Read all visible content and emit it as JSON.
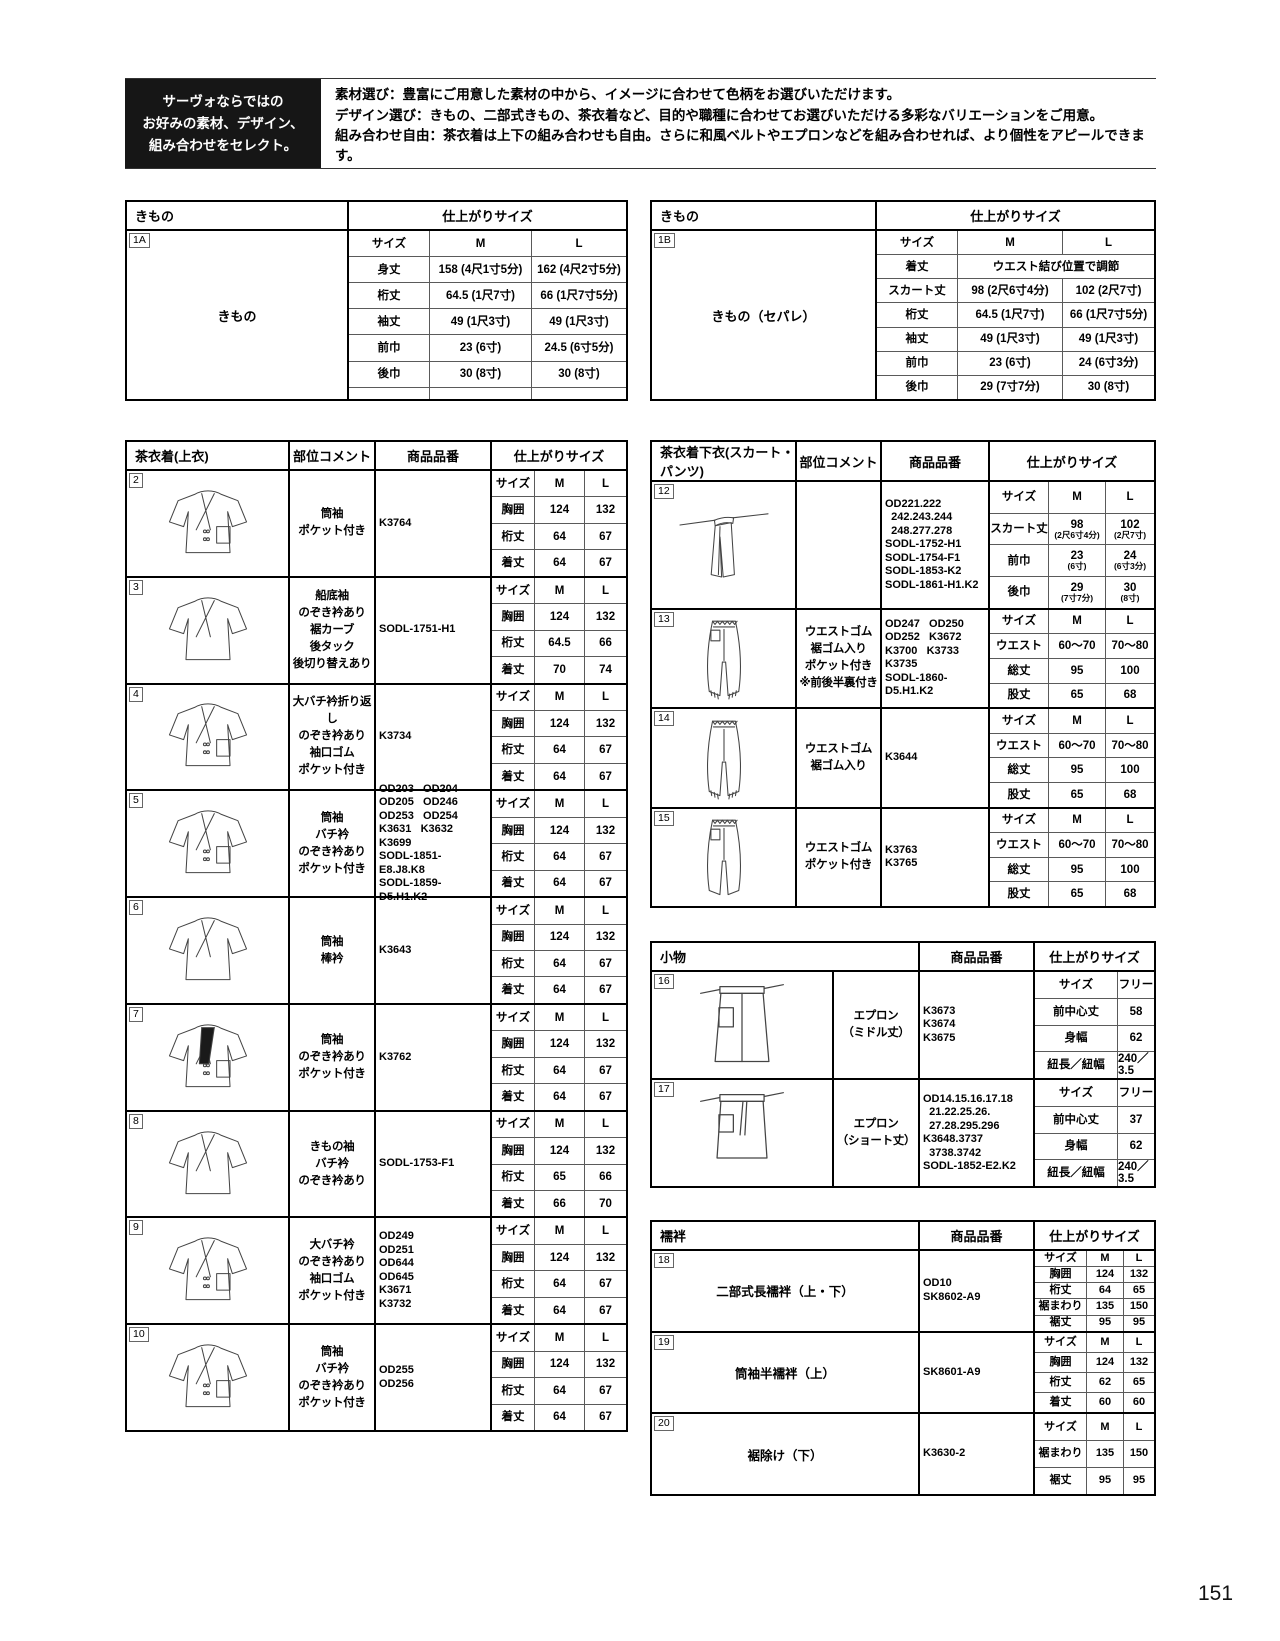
{
  "colors": {
    "header_box_bg": "#161616",
    "border_black": "#000000",
    "grid_gray": "#5a5a5a"
  },
  "header": {
    "select_box": "サーヴォならではの\nお好みの素材、デザイン、\n組み合わせをセレクト。",
    "lines": [
      "素材選び：豊富にご用意した素材の中から、イメージに合わせて色柄をお選びいただけます。",
      "デザイン選び：きもの、二部式きもの、茶衣着など、目的や職種に合わせてお選びいただける多彩なバリエーションをご用意。",
      "組み合わせ自由：茶衣着は上下の組み合わせも自由。さらに和風ベルトやエプロンなどを組み合わせれば、より個性をアピールできます。"
    ]
  },
  "page_number": "151",
  "tables": {
    "kimono_a": {
      "title": "きもの",
      "size_title": "仕上がりサイズ",
      "id": "1A",
      "product_name": "きもの",
      "size": [
        [
          "サイズ",
          "M",
          "L"
        ],
        [
          "身丈",
          "158 (4尺1寸5分)",
          "162 (4尺2寸5分)"
        ],
        [
          "桁丈",
          "64.5 (1尺7寸)",
          "66 (1尺7寸5分)"
        ],
        [
          "袖丈",
          "49 (1尺3寸)",
          "49 (1尺3寸)"
        ],
        [
          "前巾",
          "23 (6寸)",
          "24.5 (6寸5分)"
        ],
        [
          "後巾",
          "30 (8寸)",
          "30 (8寸)"
        ],
        [
          "",
          "",
          ""
        ]
      ]
    },
    "kimono_b": {
      "title": "きもの",
      "size_title": "仕上がりサイズ",
      "id": "1B",
      "product_name": "きもの（セパレ）",
      "size": [
        [
          "サイズ",
          "M",
          "L"
        ],
        [
          "着丈",
          "ウエスト結び位置で調節"
        ],
        [
          "スカート丈",
          "98 (2尺6寸4分)",
          "102 (2尺7寸)"
        ],
        [
          "桁丈",
          "64.5 (1尺7寸)",
          "66 (1尺7寸5分)"
        ],
        [
          "袖丈",
          "49 (1尺3寸)",
          "49 (1尺3寸)"
        ],
        [
          "前巾",
          "23 (6寸)",
          "24 (6寸3分)"
        ],
        [
          "後巾",
          "29 (7寸7分)",
          "30 (8寸)"
        ]
      ]
    },
    "uwagi": {
      "header": [
        "茶衣着(上衣)",
        "部位コメント",
        "商品品番",
        "仕上がりサイズ"
      ],
      "rows": [
        {
          "badge": "2",
          "art": "jacket-pocket",
          "comment": "筒袖\nポケット付き",
          "code": "K3764",
          "size": [
            [
              "サイズ",
              "M",
              "L"
            ],
            [
              "胸囲",
              "124",
              "132"
            ],
            [
              "桁丈",
              "64",
              "67"
            ],
            [
              "着丈",
              "64",
              "67"
            ]
          ]
        },
        {
          "badge": "3",
          "art": "jacket",
          "comment": "船底袖\nのぞき衿あり\n裾カーブ\n後タック\n後切り替えあり",
          "code": "SODL-1751-H1",
          "size": [
            [
              "サイズ",
              "M",
              "L"
            ],
            [
              "胸囲",
              "124",
              "132"
            ],
            [
              "桁丈",
              "64.5",
              "66"
            ],
            [
              "着丈",
              "70",
              "74"
            ]
          ]
        },
        {
          "badge": "4",
          "art": "jacket-pocket",
          "comment": "大バチ衿折り返し\nのぞき衿あり\n袖口ゴム\nポケット付き",
          "code": "K3734",
          "size": [
            [
              "サイズ",
              "M",
              "L"
            ],
            [
              "胸囲",
              "124",
              "132"
            ],
            [
              "桁丈",
              "64",
              "67"
            ],
            [
              "着丈",
              "64",
              "67"
            ]
          ]
        },
        {
          "badge": "5",
          "art": "jacket-pocket",
          "comment": "筒袖\nバチ衿\nのぞき衿あり\nポケット付き",
          "code": "OD203   OD204\nOD205   OD246\nOD253   OD254\nK3631   K3632\nK3699\nSODL-1851-E8.J8.K8\nSODL-1859-D5.H1.K2",
          "size": [
            [
              "サイズ",
              "M",
              "L"
            ],
            [
              "胸囲",
              "124",
              "132"
            ],
            [
              "桁丈",
              "64",
              "67"
            ],
            [
              "着丈",
              "64",
              "67"
            ]
          ]
        },
        {
          "badge": "6",
          "art": "jacket",
          "comment": "筒袖\n棒衿",
          "code": "K3643",
          "size": [
            [
              "サイズ",
              "M",
              "L"
            ],
            [
              "胸囲",
              "124",
              "132"
            ],
            [
              "桁丈",
              "64",
              "67"
            ],
            [
              "着丈",
              "64",
              "67"
            ]
          ]
        },
        {
          "badge": "7",
          "art": "jacket-dark",
          "comment": "筒袖\nのぞき衿あり\nポケット付き",
          "code": "K3762",
          "size": [
            [
              "サイズ",
              "M",
              "L"
            ],
            [
              "胸囲",
              "124",
              "132"
            ],
            [
              "桁丈",
              "64",
              "67"
            ],
            [
              "着丈",
              "64",
              "67"
            ]
          ]
        },
        {
          "badge": "8",
          "art": "jacket",
          "comment": "きもの袖\nバチ衿\nのぞき衿あり",
          "code": "SODL-1753-F1",
          "size": [
            [
              "サイズ",
              "M",
              "L"
            ],
            [
              "胸囲",
              "124",
              "132"
            ],
            [
              "桁丈",
              "65",
              "66"
            ],
            [
              "着丈",
              "66",
              "70"
            ]
          ]
        },
        {
          "badge": "9",
          "art": "jacket-pocket",
          "comment": "大バチ衿\nのぞき衿あり\n袖口ゴム\nポケット付き",
          "code": "OD249\nOD251\nOD644\nOD645\nK3671\nK3732",
          "size": [
            [
              "サイズ",
              "M",
              "L"
            ],
            [
              "胸囲",
              "124",
              "132"
            ],
            [
              "桁丈",
              "64",
              "67"
            ],
            [
              "着丈",
              "64",
              "67"
            ]
          ]
        },
        {
          "badge": "10",
          "art": "jacket-pocket",
          "comment": "筒袖\nバチ衿\nのぞき衿あり\nポケット付き",
          "code": "OD255\nOD256",
          "size": [
            [
              "サイズ",
              "M",
              "L"
            ],
            [
              "胸囲",
              "124",
              "132"
            ],
            [
              "桁丈",
              "64",
              "67"
            ],
            [
              "着丈",
              "64",
              "67"
            ]
          ]
        }
      ]
    },
    "shitagi": {
      "header": [
        "茶衣着下衣(スカート・パンツ)",
        "部位コメント",
        "商品品番",
        "仕上がりサイズ"
      ],
      "rows": [
        {
          "badge": "12",
          "art": "skirt",
          "comment": "",
          "code": "OD221.222\n  242.243.244\n  248.277.278\nSODL-1752-H1\nSODL-1754-F1\nSODL-1853-K2\nSODL-1861-H1.K2",
          "size": [
            [
              "サイズ",
              "M",
              "L"
            ],
            [
              "スカート丈",
              "98\n(2尺6寸4分)",
              "102\n(2尺7寸)"
            ],
            [
              "前巾",
              "23\n(6寸)",
              "24\n(6寸3分)"
            ],
            [
              "後巾",
              "29\n(7寸7分)",
              "30\n(8寸)"
            ]
          ]
        },
        {
          "badge": "13",
          "art": "pants-a",
          "comment": "ウエストゴム\n裾ゴム入り\nポケット付き\n※前後半裏付き",
          "code": "OD247   OD250\nOD252   K3672\nK3700   K3733\nK3735\nSODL-1860-D5.H1.K2",
          "size": [
            [
              "サイズ",
              "M",
              "L"
            ],
            [
              "ウエスト",
              "60〜70",
              "70〜80"
            ],
            [
              "総丈",
              "95",
              "100"
            ],
            [
              "股丈",
              "65",
              "68"
            ]
          ]
        },
        {
          "badge": "14",
          "art": "pants-b",
          "comment": "ウエストゴム\n裾ゴム入り",
          "code": "K3644",
          "size": [
            [
              "サイズ",
              "M",
              "L"
            ],
            [
              "ウエスト",
              "60〜70",
              "70〜80"
            ],
            [
              "総丈",
              "95",
              "100"
            ],
            [
              "股丈",
              "65",
              "68"
            ]
          ]
        },
        {
          "badge": "15",
          "art": "pants-c",
          "comment": "ウエストゴム\nポケット付き",
          "code": "K3763\nK3765",
          "size": [
            [
              "サイズ",
              "M",
              "L"
            ],
            [
              "ウエスト",
              "60〜70",
              "70〜80"
            ],
            [
              "総丈",
              "95",
              "100"
            ],
            [
              "股丈",
              "65",
              "68"
            ]
          ]
        }
      ]
    },
    "komono": {
      "header": [
        "小物",
        "商品品番",
        "仕上がりサイズ"
      ],
      "rows": [
        {
          "badge": "16",
          "art": "apron",
          "comment": "エプロン\n（ミドル丈）",
          "code": "K3673\nK3674\nK3675",
          "size": [
            [
              "サイズ",
              "フリー"
            ],
            [
              "前中心丈",
              "58"
            ],
            [
              "身幅",
              "62"
            ],
            [
              "紐長／紐幅",
              "240／3.5"
            ]
          ]
        },
        {
          "badge": "17",
          "art": "apron-short",
          "comment": "エプロン\n（ショート丈）",
          "code": "OD14.15.16.17.18\n  21.22.25.26.\n  27.28.295.296\nK3648.3737\n  3738.3742\nSODL-1852-E2.K2",
          "size": [
            [
              "サイズ",
              "フリー"
            ],
            [
              "前中心丈",
              "37"
            ],
            [
              "身幅",
              "62"
            ],
            [
              "紐長／紐幅",
              "240／3.5"
            ]
          ]
        }
      ]
    },
    "juban": {
      "header": [
        "襦袢",
        "商品品番",
        "仕上がりサイズ"
      ],
      "rows": [
        {
          "badge": "18",
          "name": "二部式長襦袢（上・下）",
          "code": "OD10\nSK8602-A9",
          "size": [
            [
              "サイズ",
              "M",
              "L"
            ],
            [
              "胸囲",
              "124",
              "132"
            ],
            [
              "桁丈",
              "64",
              "65"
            ],
            [
              "裾まわり",
              "135",
              "150"
            ],
            [
              "裾丈",
              "95",
              "95"
            ]
          ]
        },
        {
          "badge": "19",
          "name": "筒袖半襦袢（上）",
          "code": "SK8601-A9",
          "size": [
            [
              "サイズ",
              "M",
              "L"
            ],
            [
              "胸囲",
              "124",
              "132"
            ],
            [
              "桁丈",
              "62",
              "65"
            ],
            [
              "着丈",
              "60",
              "60"
            ]
          ]
        },
        {
          "badge": "20",
          "name": "裾除け（下）",
          "code": "K3630-2",
          "size": [
            [
              "サイズ",
              "M",
              "L"
            ],
            [
              "裾まわり",
              "135",
              "150"
            ],
            [
              "裾丈",
              "95",
              "95"
            ]
          ]
        }
      ]
    }
  }
}
